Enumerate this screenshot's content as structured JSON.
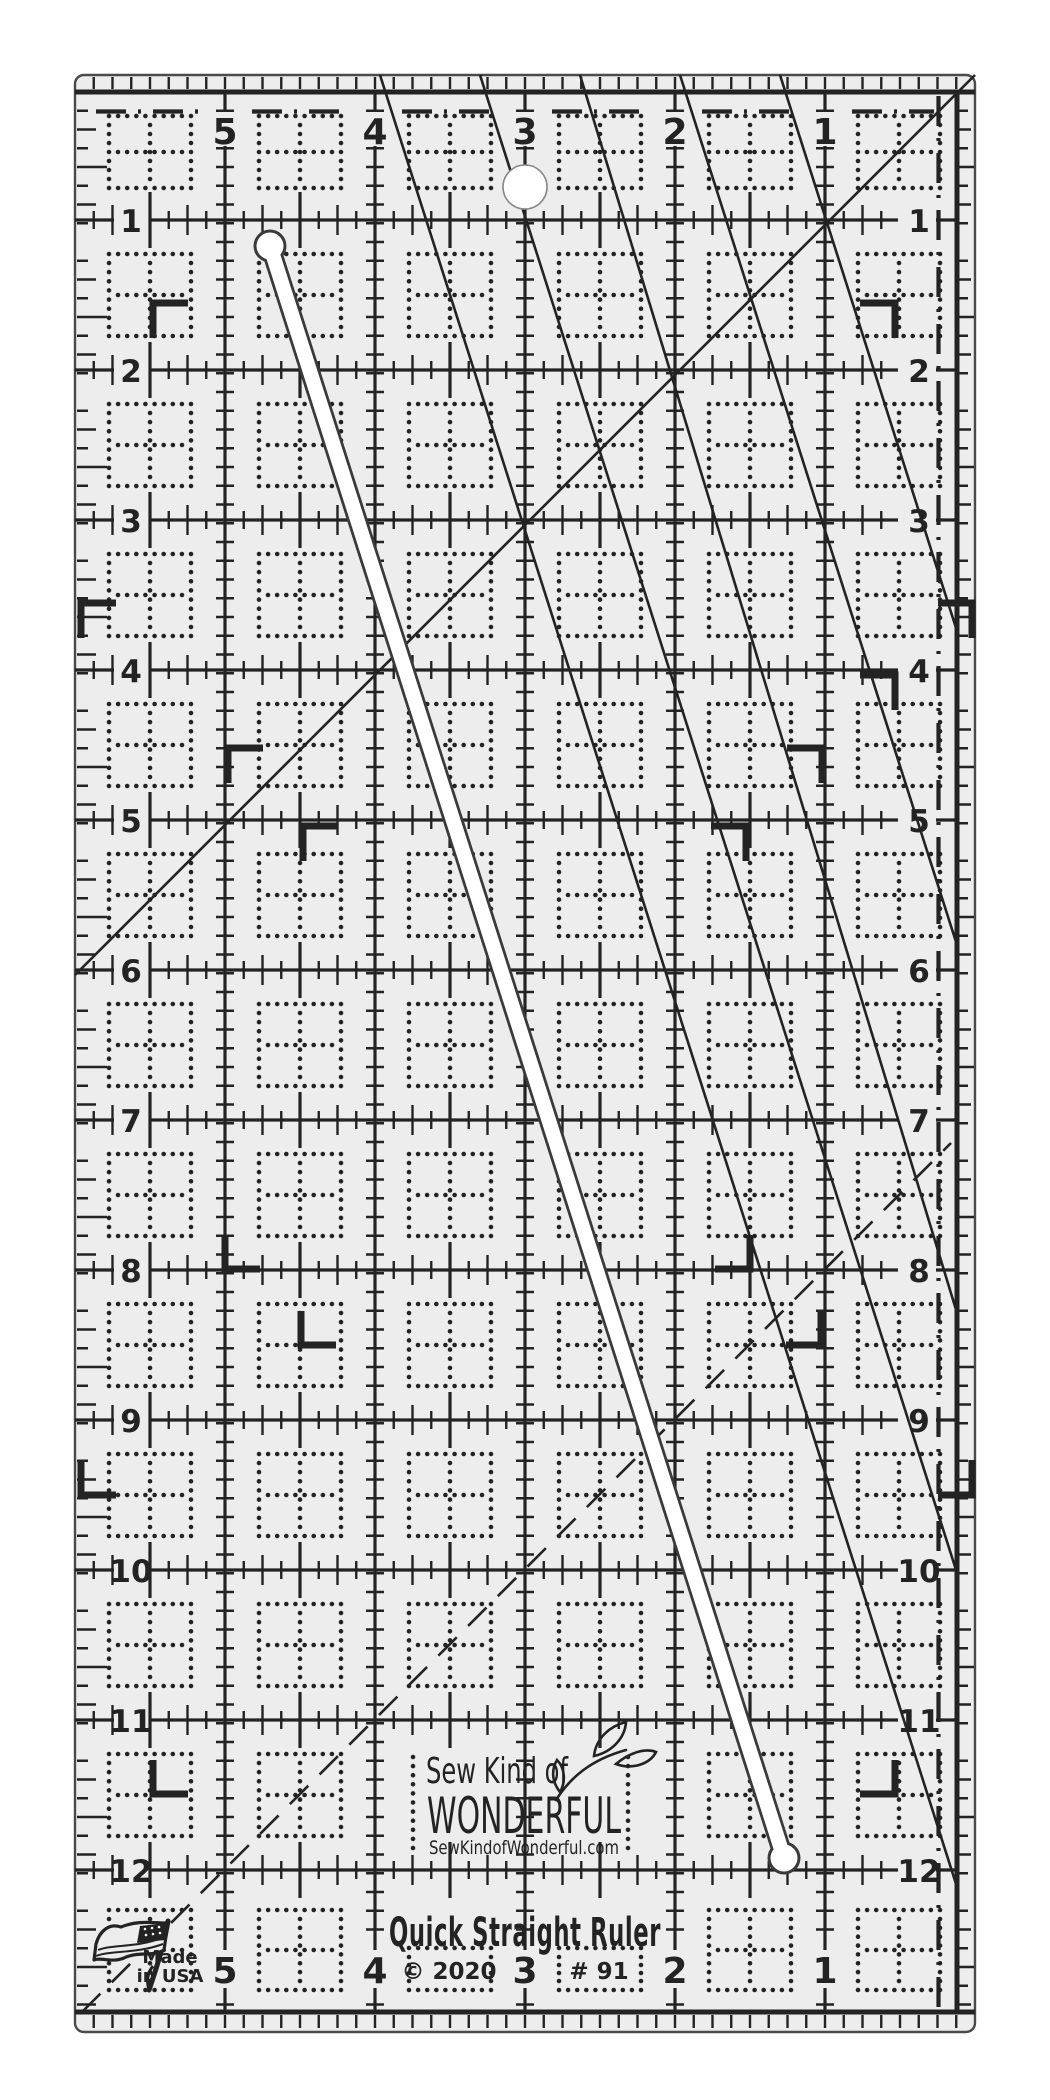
{
  "ruler": {
    "columns_top": [
      "5",
      "4",
      "3",
      "2",
      "1"
    ],
    "columns_bottom": [
      "5",
      "4",
      "3",
      "2",
      "1"
    ],
    "rows_left": [
      "1",
      "2",
      "3",
      "4",
      "5",
      "6",
      "7",
      "8",
      "9",
      "10",
      "11",
      "12"
    ],
    "rows_right": [
      "1",
      "2",
      "3",
      "4",
      "5",
      "6",
      "7",
      "8",
      "9",
      "10",
      "11",
      "12"
    ],
    "brand": {
      "line1": "Sew Kind of",
      "line2": "WONDERFUL",
      "website": "SewKindofWonderful.com"
    },
    "title": "Quick Straight Ruler",
    "copyright": "© 2020",
    "model_number": "# 91",
    "made_in": {
      "line1": "Made",
      "line2": "in USA"
    },
    "colors": {
      "ink": "#232323",
      "body": "#ededed",
      "background": "#ffffff",
      "cutout": "#ffffff",
      "outline": "#4a4a4a"
    }
  }
}
